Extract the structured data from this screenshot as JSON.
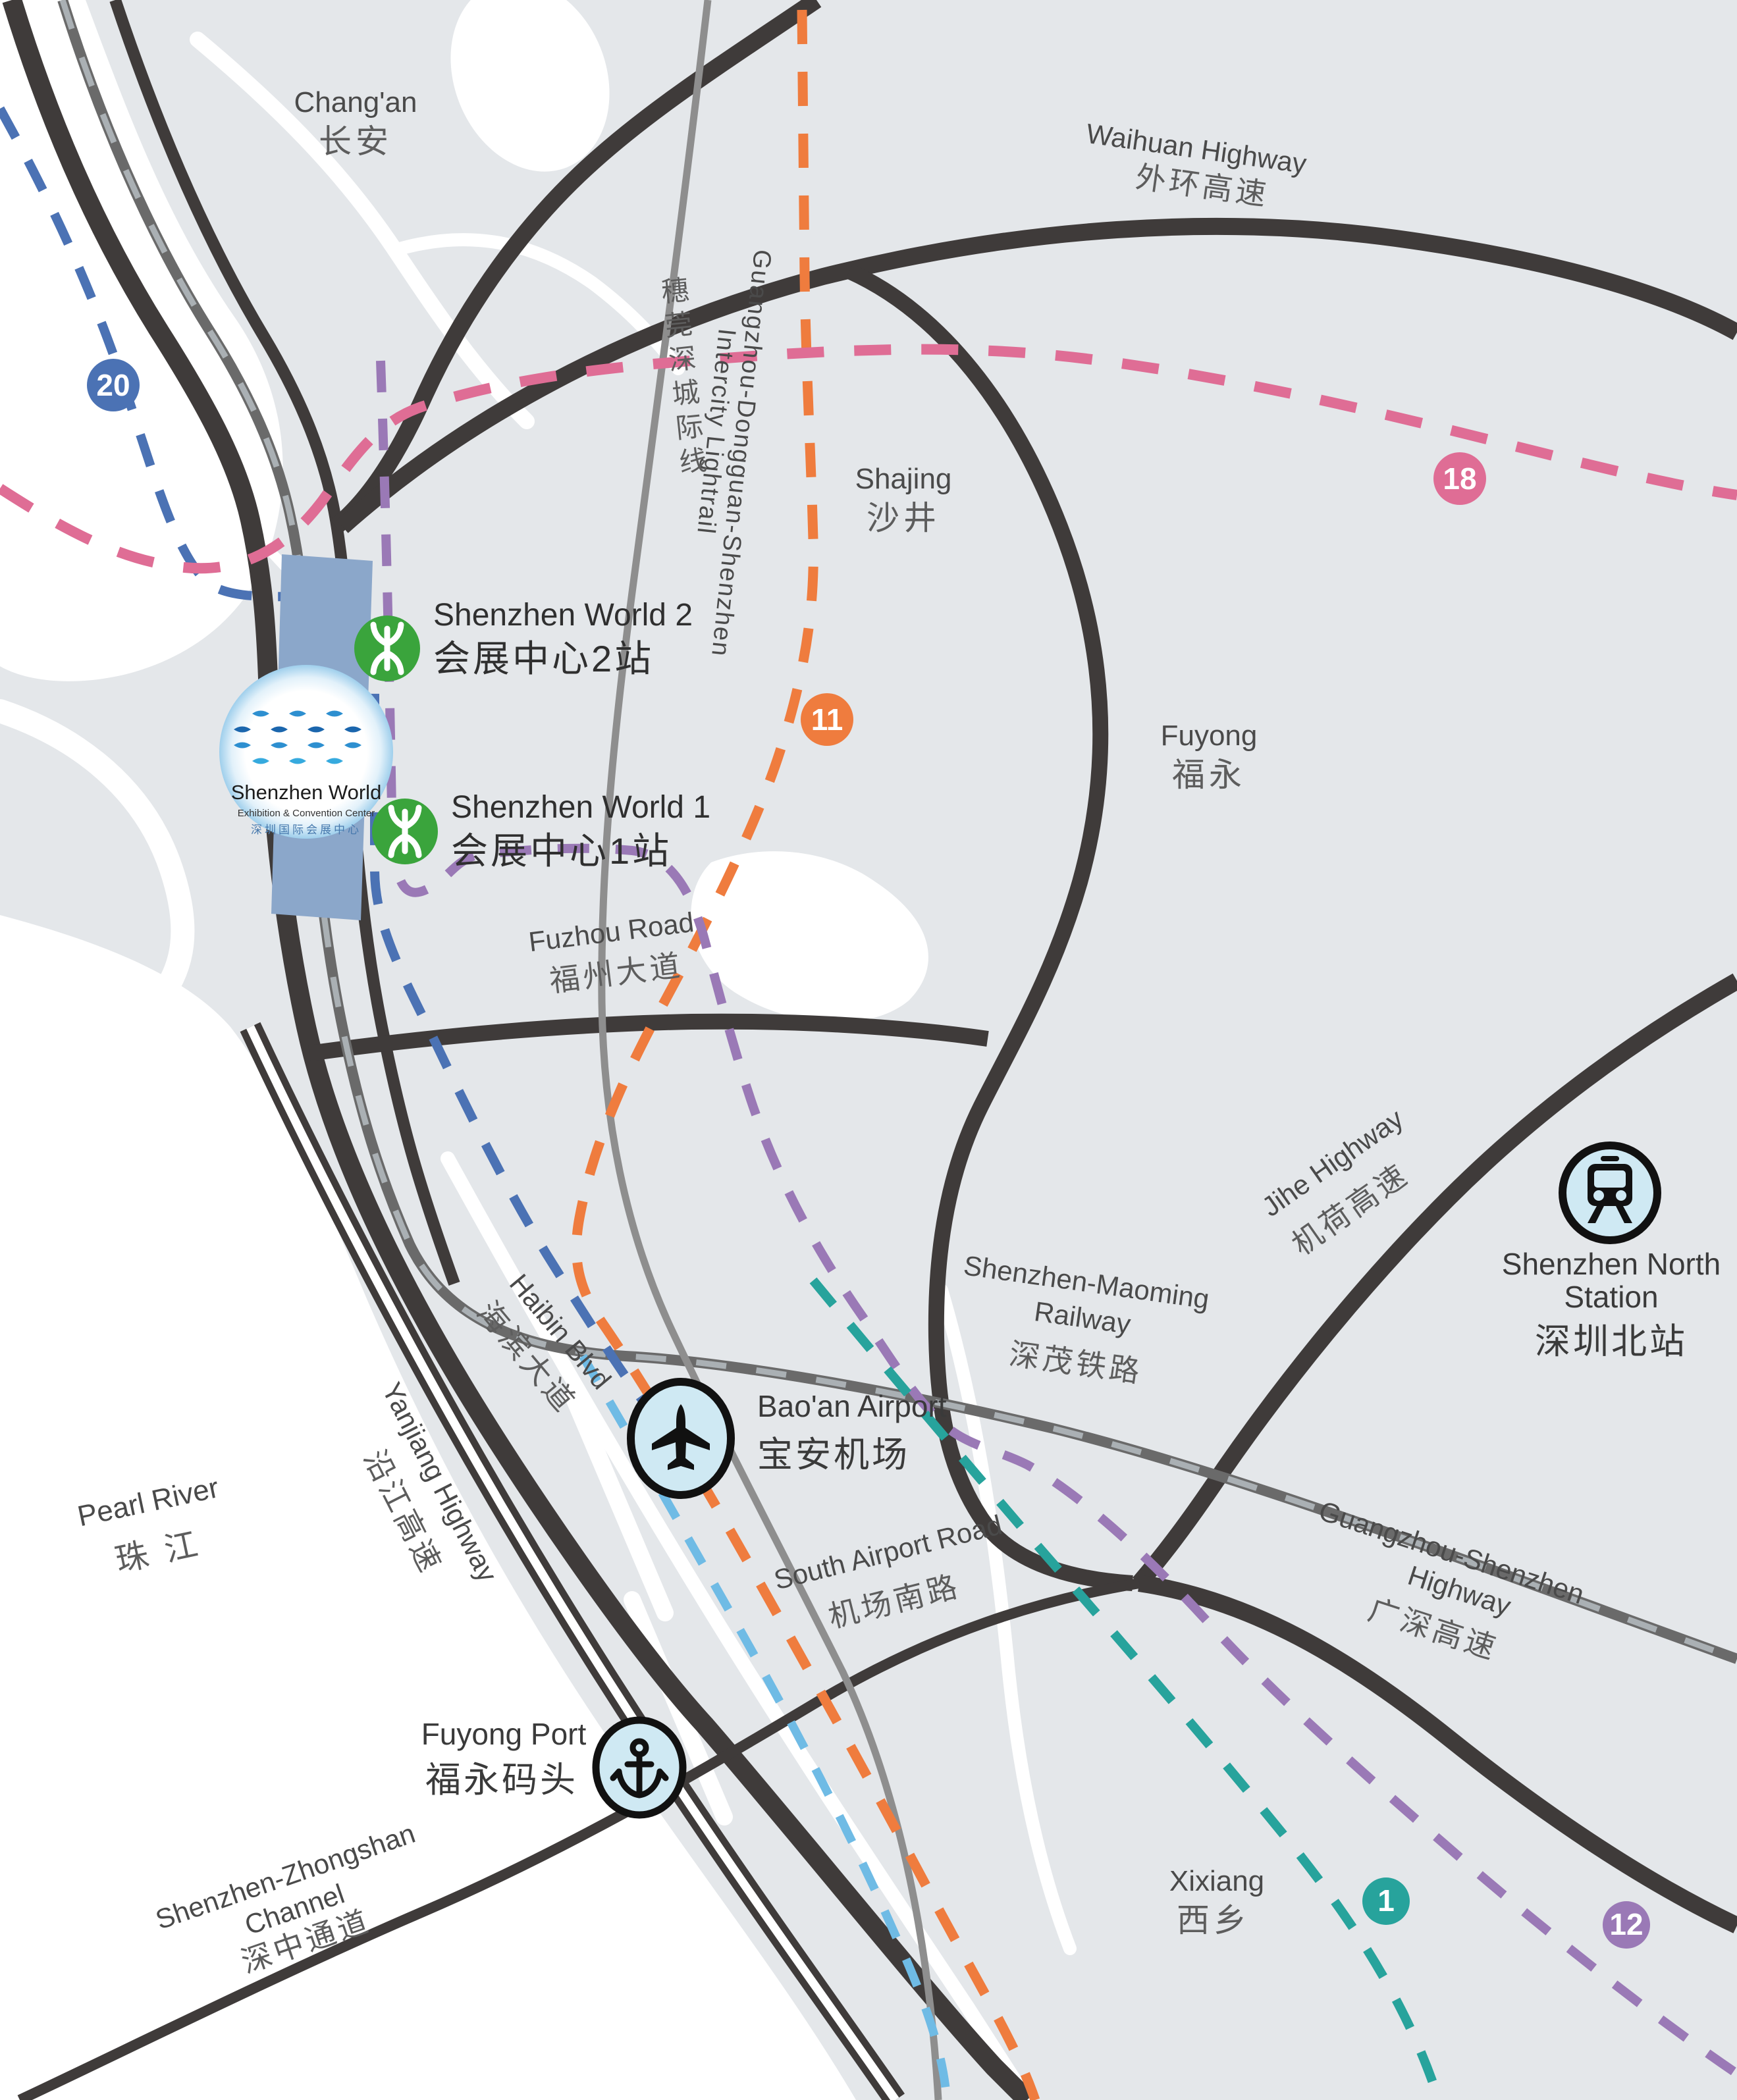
{
  "colors": {
    "land": "#e4e7ea",
    "water": "#ffffff",
    "road_dark": "#3f3b3a",
    "railway": "#6a6a6a",
    "railway_dash": "#aab0b4",
    "lightrail_gray": "#8e8e8e",
    "line20": "#4b72b4",
    "line11": "#ef7c3e",
    "line18": "#df6d95",
    "line1": "#27a39c",
    "line12": "#9a79b6",
    "airport_line": "#6fbbe5",
    "station_green": "#3aa43c",
    "poi_fill": "#cfe9f3",
    "building": "#8ba7ca"
  },
  "areas": {
    "changan": {
      "en": "Chang'an",
      "zh": "长安"
    },
    "shajing": {
      "en": "Shajing",
      "zh": "沙井"
    },
    "fuyong": {
      "en": "Fuyong",
      "zh": "福永"
    },
    "xixiang": {
      "en": "Xixiang",
      "zh": "西乡"
    },
    "pearl_river": {
      "en": "Pearl River",
      "zh": "珠 江"
    }
  },
  "roads": {
    "waihuan": {
      "en": "Waihuan Highway",
      "zh": "外环高速"
    },
    "fuzhou": {
      "en": "Fuzhou Road",
      "zh": "福州大道"
    },
    "jihe": {
      "en": "Jihe Highway",
      "zh": "机荷高速"
    },
    "haibin": {
      "en": "Haibin Blvd",
      "zh": "海滨大道"
    },
    "yanjiang": {
      "en": "Yanjiang Highway",
      "zh": "沿江高速"
    },
    "south_airport": {
      "en": "South Airport Road",
      "zh": "机场南路"
    },
    "guangshen": {
      "en_line1": "Guangzhou-Shenzhen",
      "en_line2": "Highway",
      "zh": "广深高速"
    },
    "szzs_channel": {
      "en_line1": "Shenzhen-Zhongshan",
      "en_line2": "Channel",
      "zh": "深中通道"
    }
  },
  "railways": {
    "maoming": {
      "en_line1": "Shenzhen-Maoming",
      "en_line2": "Railway",
      "zh": "深茂铁路"
    },
    "intercity": {
      "en_line1": "Guangzhou-Dongguan-Shenzhen",
      "en_line2": "Intercity Lightrail",
      "zh": "穗莞深城际线"
    }
  },
  "metro": {
    "badge20": "20",
    "badge11": "11",
    "badge18": "18",
    "badge1": "1",
    "badge12": "12"
  },
  "stations": {
    "sw2": {
      "en": "Shenzhen World 2",
      "zh": "会展中心2站"
    },
    "sw1": {
      "en": "Shenzhen World 1",
      "zh": "会展中心1站"
    }
  },
  "pois": {
    "airport": {
      "en": "Bao'an Airport",
      "zh": "宝安机场"
    },
    "port": {
      "en": "Fuyong Port",
      "zh": "福永码头"
    },
    "north_station": {
      "en_line1": "Shenzhen North",
      "en_line2": "Station",
      "zh": "深圳北站"
    }
  },
  "logo": {
    "name": "Shenzhen World",
    "subtitle": "Exhibition & Convention Center",
    "zh": "深圳国际会展中心"
  }
}
